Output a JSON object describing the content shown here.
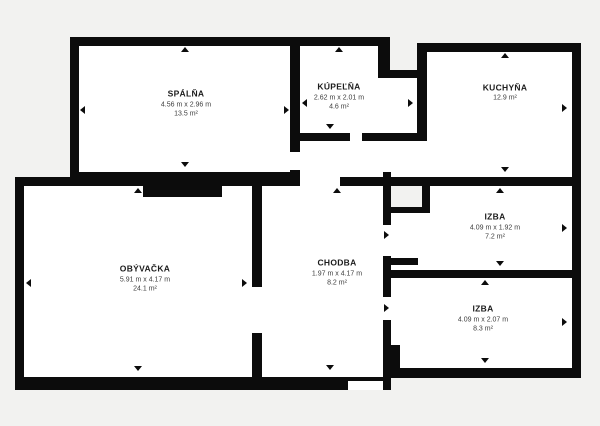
{
  "plan": {
    "background_color": "#f2f2f0",
    "wall_color": "#0c0c0c",
    "room_fill_color": "#ffffff",
    "rooms": [
      {
        "id": "spalna",
        "name": "SPÁLŇA",
        "dimensions": "4.56 m x 2.96 m",
        "area": "13.5 m²"
      },
      {
        "id": "kupelna",
        "name": "KÚPEĽŇA",
        "dimensions": "2.62 m x 2.01 m",
        "area": "4.6 m²"
      },
      {
        "id": "kuchyna",
        "name": "KUCHYŇA",
        "dimensions": "",
        "area": "12.9 m²"
      },
      {
        "id": "obyvacka",
        "name": "OBÝVAČKA",
        "dimensions": "5.91 m x 4.17 m",
        "area": "24.1 m²"
      },
      {
        "id": "chodba",
        "name": "CHODBA",
        "dimensions": "1.97 m x 4.17 m",
        "area": "8.2 m²"
      },
      {
        "id": "izba-horna",
        "name": "IZBA",
        "dimensions": "4.09 m x 1.92 m",
        "area": "7.2 m²"
      },
      {
        "id": "izba-dolna",
        "name": "IZBA",
        "dimensions": "4.09 m x 2.07 m",
        "area": "8.3 m²"
      }
    ]
  }
}
